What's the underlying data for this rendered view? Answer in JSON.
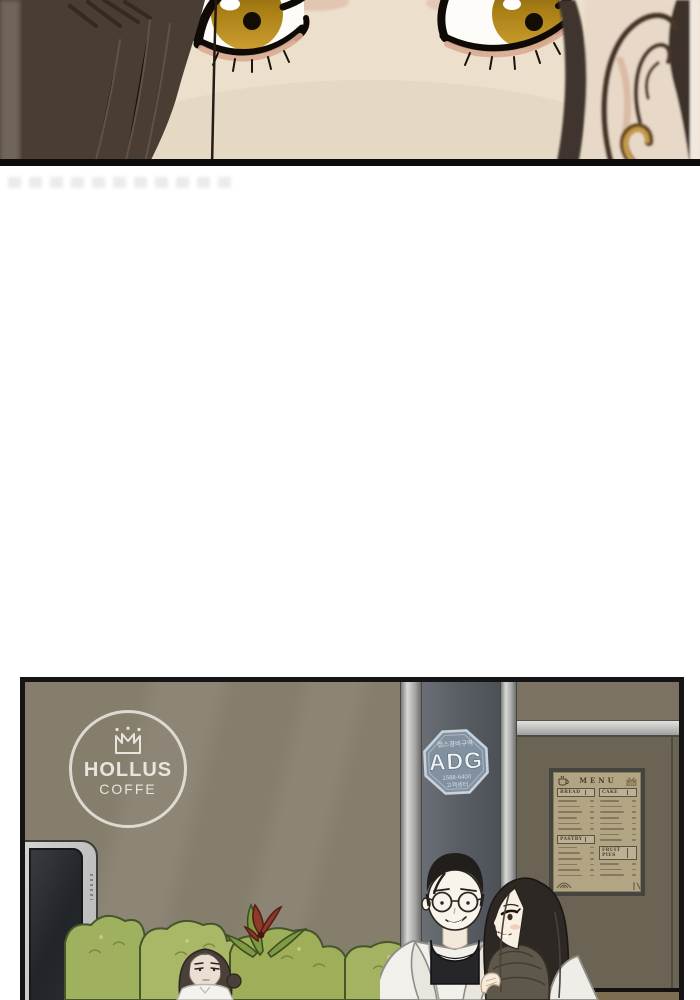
{
  "scene": {
    "kind": "webtoon comic page",
    "panel_top": "close-up of a woman's amber eyes",
    "panel_bottom": "exterior of a coffee shop with three characters"
  },
  "storefront": {
    "logo": {
      "icon": "crown",
      "line1": "HOLLUS",
      "line2": "COFFE"
    },
    "security_badge": {
      "top_text": "캡스경비구역",
      "brand": "ADG",
      "phone": "1588-6400",
      "bottom_text": "고객센터"
    },
    "menu_board": {
      "title": "MENU",
      "sections": [
        {
          "name": "BREAD",
          "column": 0,
          "items": 6
        },
        {
          "name": "PASTRY",
          "column": 0,
          "items": 6
        },
        {
          "name": "CAKE",
          "column": 1,
          "items": 8
        },
        {
          "name": "FRUIT PIES",
          "column": 1,
          "items": 3
        }
      ]
    }
  },
  "colors": {
    "wall_taupe": "#867e6d",
    "pillar_gray": "#5a5f65",
    "metal_strip": "#c6c6c4",
    "door_olive": "#6b6454",
    "floor_brown": "#7c6c50",
    "menu_paper": "#b2a583",
    "menu_ink": "#4c3e2c",
    "badge_blue": "#82919f",
    "bush_green": "#a3b364",
    "flower_red": "#8e3a2b",
    "skin_tone": "#ecdfcc",
    "iris_amber": "#b98a1e",
    "hair_dark": "#463b33"
  }
}
